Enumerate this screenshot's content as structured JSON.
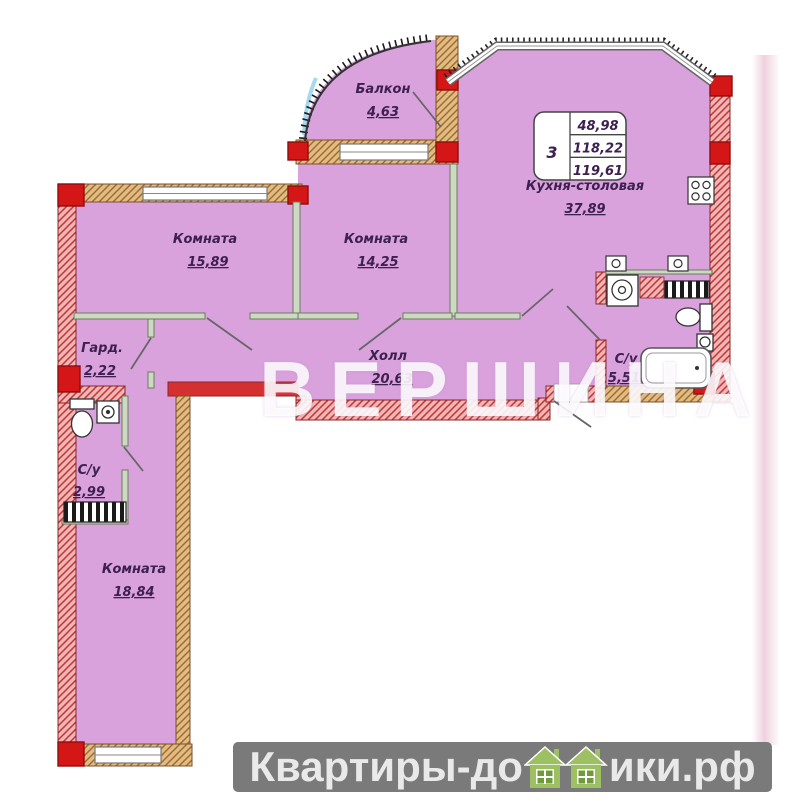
{
  "plan": {
    "info_box": {
      "rooms": "3",
      "living_area": "48,98",
      "floor_area": "118,22",
      "total_area": "119,61"
    },
    "rooms": [
      {
        "name": "Балкон",
        "area": "4,63"
      },
      {
        "name": "Комната",
        "area": "15,89"
      },
      {
        "name": "Комната",
        "area": "14,25"
      },
      {
        "name": "Кухня-столовая",
        "area": "37,89"
      },
      {
        "name": "Холл",
        "area": "20,63"
      },
      {
        "name": "Гард.",
        "area": "2,22"
      },
      {
        "name": "С/у",
        "area": "2,99"
      },
      {
        "name": "С/у",
        "area": "5,51"
      },
      {
        "name": "Комната",
        "area": "18,84"
      }
    ]
  },
  "watermark": {
    "text": "ВЕРШИНА"
  },
  "footer": {
    "text_left": "Квартиры-до",
    "text_right": "ики.рф"
  },
  "colors": {
    "floor": "#d9a2dc",
    "wall_red": "#d51616",
    "wall_hatch_red_bg": "#f0b6b6",
    "wall_hatch_tan_bg": "#e2bb82",
    "partition_green": "#cdd9c2",
    "label_text": "#3d2050",
    "footer_bar": "#7a7a7a",
    "house_green": "#9dc162",
    "watermark_white": "#ffffff"
  }
}
